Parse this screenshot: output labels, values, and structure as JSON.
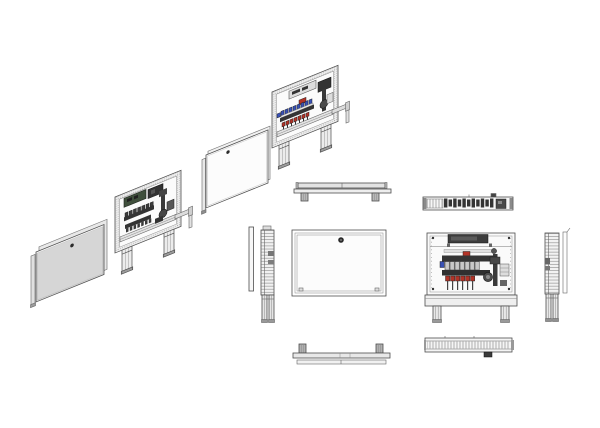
{
  "drawing": {
    "type": "technical-assembly-drawing",
    "subject": "manifold-cabinet-exploded-and-orthographic-views",
    "background": "#ffffff"
  },
  "colors": {
    "line": "#4d4d4d",
    "panel_gray": "#d6d6d6",
    "panel_white": "#fcfcfc",
    "frame_fill": "#ededed",
    "dark_part": "#343434",
    "valve_red": "#b23327",
    "valve_blue": "#3951b5",
    "controller_green": "#3f4f3c",
    "metal_gray": "#9c9c9c"
  },
  "views": {
    "iso_exploded_sequence": [
      {
        "name": "front-door-with-frame"
      },
      {
        "name": "cabinet-with-manifold-rear-side"
      },
      {
        "name": "inner-door-panel"
      },
      {
        "name": "cabinet-with-manifold-front-side"
      }
    ],
    "orthographic_closed_cabinet": [
      "top-view",
      "side-view-left",
      "front-view",
      "bottom-view"
    ],
    "orthographic_open_cabinet": [
      "top-view",
      "front-view",
      "side-view-right",
      "bottom-view"
    ]
  }
}
